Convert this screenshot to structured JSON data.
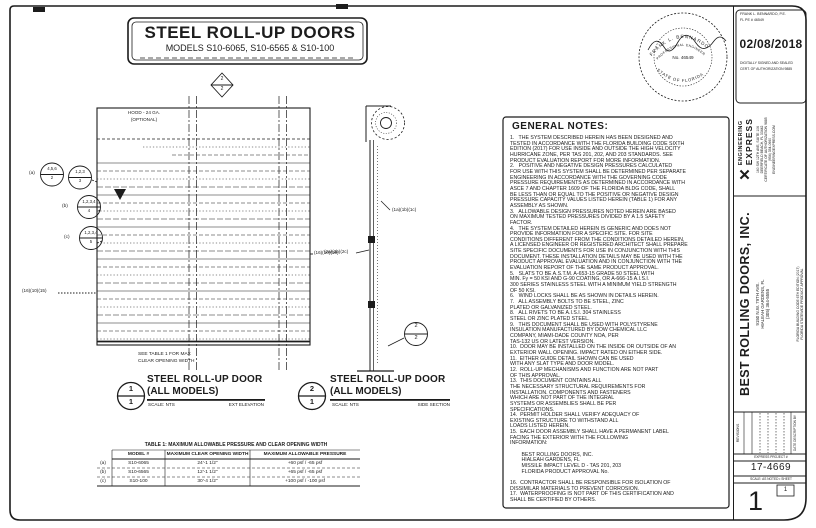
{
  "header": {
    "title": "STEEL ROLL-UP DOORS",
    "subtitle": "MODELS S10-6065, S10-6565 & S10-100"
  },
  "elevation": {
    "hood_line1": "HOOD - 24 GA.",
    "hood_line2": "(OPTIONAL)",
    "see_table_line1": "SEE TABLE 1 FOR MAX",
    "see_table_line2": "CLEAR OPENING WIDTH",
    "callout_a_label": "(a)",
    "callout_a1_num": "4,5,6",
    "callout_a1_den": "2",
    "callout_a2_num": "1,2,3",
    "callout_a2_den": "3",
    "callout_b_label": "(b)",
    "callout_b_num": "1,2,3,4",
    "callout_b_den": "4",
    "callout_c_label": "(c)",
    "callout_c_num": "1,2,3,4",
    "callout_c_den": "5",
    "left_refs": "(16)(10)(15)",
    "right_refs": "(16)(10)(15)",
    "cut_marker_num": "2",
    "cut_marker_den": "2"
  },
  "section": {
    "refs_right": "(1a)(1b)(1c)",
    "refs_left": "(2a)(2b)(2c)",
    "detail_num": "2",
    "detail_den": "2"
  },
  "labels": {
    "d1_num": "1",
    "d1_den": "1",
    "d1_title1": "STEEL ROLL-UP DOOR",
    "d1_title2": "(ALL MODELS)",
    "d1_scale": "SCALE: NTS",
    "d1_view": "EXT ELEVATION",
    "d2_num": "2",
    "d2_den": "1",
    "d2_title1": "STEEL ROLL-UP DOOR",
    "d2_title2": "(ALL MODELS)",
    "d2_scale": "SCALE: NTS",
    "d2_view": "SIDE SECTION"
  },
  "table1": {
    "title": "TABLE 1: MAXIMUM ALLOWABLE PRESSURE AND CLEAR OPENING WIDTH",
    "headers": [
      "MODEL #",
      "MAXIMUM CLEAR OPENING WIDTH",
      "MAXIMUM ALLOWABLE PRESSURE"
    ],
    "rows": [
      {
        "tag": "(a)",
        "model": "S10-6065",
        "width": "24'-1 1/2\"",
        "pressure": "+60 psf / -65 psf"
      },
      {
        "tag": "(b)",
        "model": "S10-6565",
        "width": "12'-1 1/2\"",
        "pressure": "+65 psf / -65 psf"
      },
      {
        "tag": "(c)",
        "model": "S10-100",
        "width": "30'-4 1/2\"",
        "pressure": "+100 psf / -100 psf"
      }
    ]
  },
  "notes": {
    "title": "GENERAL NOTES:",
    "body": "1.   THE SYSTEM DESCRIBED HEREIN HAS BEEN DESIGNED AND\nTESTED IN ACCORDANCE WITH THE FLORIDA BUILDING CODE SIXTH\nEDITION (2017) FOR USE INSIDE AND OUTSIDE THE HIGH VELOCITY\nHURRICANE ZONE, PER TAS 201, 202, AND 203 STANDARDS. SEE\nPRODUCT EVALUATION REPORT FOR MORE INFORMATION.\n2.   POSITIVE AND NEGATIVE DESIGN PRESSURES CALCULATED\nFOR USE WITH THIS SYSTEM SHALL BE DETERMINED PER SEPARATE\nENGINEERING IN ACCORDANCE WITH THE GOVERNING CODE\nPRESSURE REQUIREMENTS AS DETERMINED IN ACCORDANCE WITH\nASCE 7 AND CHAPTER 1609 OF THE FLORIDA BLDG CODE, SHALL\nBE LESS THAN OR EQUAL TO THE POSITIVE OR NEGATIVE DESIGN\nPRESSURE CAPACITY VALUES LISTED HEREIN (TABLE 1) FOR ANY\nASSEMBLY AS SHOWN.\n3.   ALLOWABLE DESIGN PRESSURES NOTED HEREIN ARE BASED\nON MAXIMUM TESTED PRESSURES DIVIDED BY A 1.5 SAFETY\nFACTOR.\n4.   THE SYSTEM DETAILED HEREIN IS GENERIC AND DOES NOT\nPROVIDE INFORMATION FOR A SPECIFIC SITE. FOR SITE\nCONDITIONS DIFFERENT FROM THE CONDITIONS DETAILED HEREIN,\nA LICENSED ENGINEER OR REGISTERED ARCHITECT SHALL PREPARE\nSITE SPECIFIC DOCUMENTS FOR USE IN CONJUNCTION WITH THIS\nDOCUMENT. THESE INSTALLATION DETAILS MAY BE USED WITH THE\nPRODUCT APPROVAL EVALUATION AND IN CONJUNCTION WITH THE\nEVALUATION REPORT OF THE SAME PRODUCT APPROVAL.\n5.   SLATS TO BE A.S.T.M. A-653-15 GRADE 50 STEEL WITH\nMIN. Fy = 50 KSI AND G-90 COATING, OR A-666-15 A.I.S.I.\n300 SERIES STAINLESS STEEL WITH A MINIMUM YIELD STRENGTH\nOF 50 KSI.\n6.   WIND LOCKS SHALL BE AS SHOWN IN DETAILS HEREIN.\n7.   ALL ASSEMBLY BOLTS TO BE STEEL, ZINC\nPLATED OR GALVANIZED STEEL.\n8.   ALL RIVETS TO BE A.I.S.I. 304 STAINLESS\nSTEEL OR ZINC PLATED STEEL.\n9.   THIS DOCUMENT SHALL BE USED WITH POLYSTYRENE\nINSULATION MANUFACTURED BY DOW CHEMICAL LLC\nCOMPANY, MIAMI-DADE COUNTY NOA, PER\nTAS-132 US OR LATEST VERSION.\n10.  DOOR MAY BE INSTALLED ON THE INSIDE OR OUTSIDE OF AN\nEXTERIOR WALL OPENING. IMPACT RATED ON EITHER SIDE.\n11.  EITHER GUIDE DETAIL SHOWN CAN BE USED\nWITH ANY SLAT TYPE AND DOOR MODEL.\n12.  ROLL-UP MECHANISMS AND FUNCTION ARE NOT PART\nOF THIS APPROVAL.\n13.  THIS DOCUMENT CONTAINS ALL\nTHE NECESSARY STRUCTURAL REQUIREMENTS FOR\nINSTALLATION. COMPONENTS AND FASTENERS\nWHICH ARE NOT PART OF THE INTEGRAL\nSYSTEMS OR ASSEMBLIES SHALL BE PER\nSPECIFICATIONS.\n14.  PERMIT HOLDER SHALL VERIFY ADEQUACY OF\nEXISTING STRUCTURE TO WITHSTAND ALL\nLOADS LISTED HEREIN.\n15.  EACH DOOR ASSEMBLY SHALL HAVE A PERMANENT LABEL\nFACING THE EXTERIOR WITH THE FOLLOWING\nINFORMATION:\n\n        BEST ROLLING DOORS, INC.\n        HIALEAH GARDENS, FL\n        MISSILE IMPACT LEVEL D - TAS 201, 203\n        FLORIDA PRODUCT APPROVAL No.\n\n16.  CONTRACTOR SHALL BE RESPONSIBLE FOR ISOLATION OF\nDISSIMILAR MATERIALS TO PREVENT CORROSION.\n17.  WATERPROOFING IS NOT PART OF THIS CERTIFICATION AND\nSHALL BE CERTIFIED BY OTHERS."
  },
  "seal": {
    "arc_top": "FRANK L. BENNARDO",
    "arc_inner": "PROFESSIONAL ENGINEER",
    "center": "No. 46549",
    "arc_bottom": "STATE OF FLORIDA"
  },
  "titleblock": {
    "pe_line1": "FRANK L. BENNARDO, P.E.",
    "pe_line2": "FL PE # 46549",
    "date": "02/08/2018",
    "sig_line1": "DIGITALLY SIGNED AND SEALED",
    "sig_line2": "CERT. OF AUTHORIZATION 9885",
    "firm_name1": "ENGINEERING",
    "firm_name2": "EXPRESS",
    "firm_addr1": "160 SW 12TH AVE, SUITE 106",
    "firm_addr2": "DEERFIELD BEACH, FL 33442",
    "firm_addr3": "CERTIFICATE OF AUTHORIZATION 9885",
    "firm_addr4": "(954) 354-0660",
    "firm_addr5": "ENGINEERINGEXPRESS.COM",
    "client_name": "BEST ROLLING DOORS, INC.",
    "client_addr1": "9150 N.W. 79TH AVE.",
    "client_addr2": "HIALEAH GARDENS, FL",
    "client_addr3": "(305) 364-5555",
    "approval1": "FLORIDA BUILDING CODE 6TH EDITION (2017)",
    "approval2": "FLORIDA STATEWIDE PRODUCT APPROVAL",
    "revisions_label": "REVISIONS",
    "rev_cols": "DATE      DESCRIPTION      BY",
    "project_bar": "EXPRESS PROJECT #",
    "project_no": "17-4669",
    "sheet_bar": "SCALE: AS NOTED  •  SHEET",
    "sheet_no": "1",
    "sheet_total": "1"
  }
}
